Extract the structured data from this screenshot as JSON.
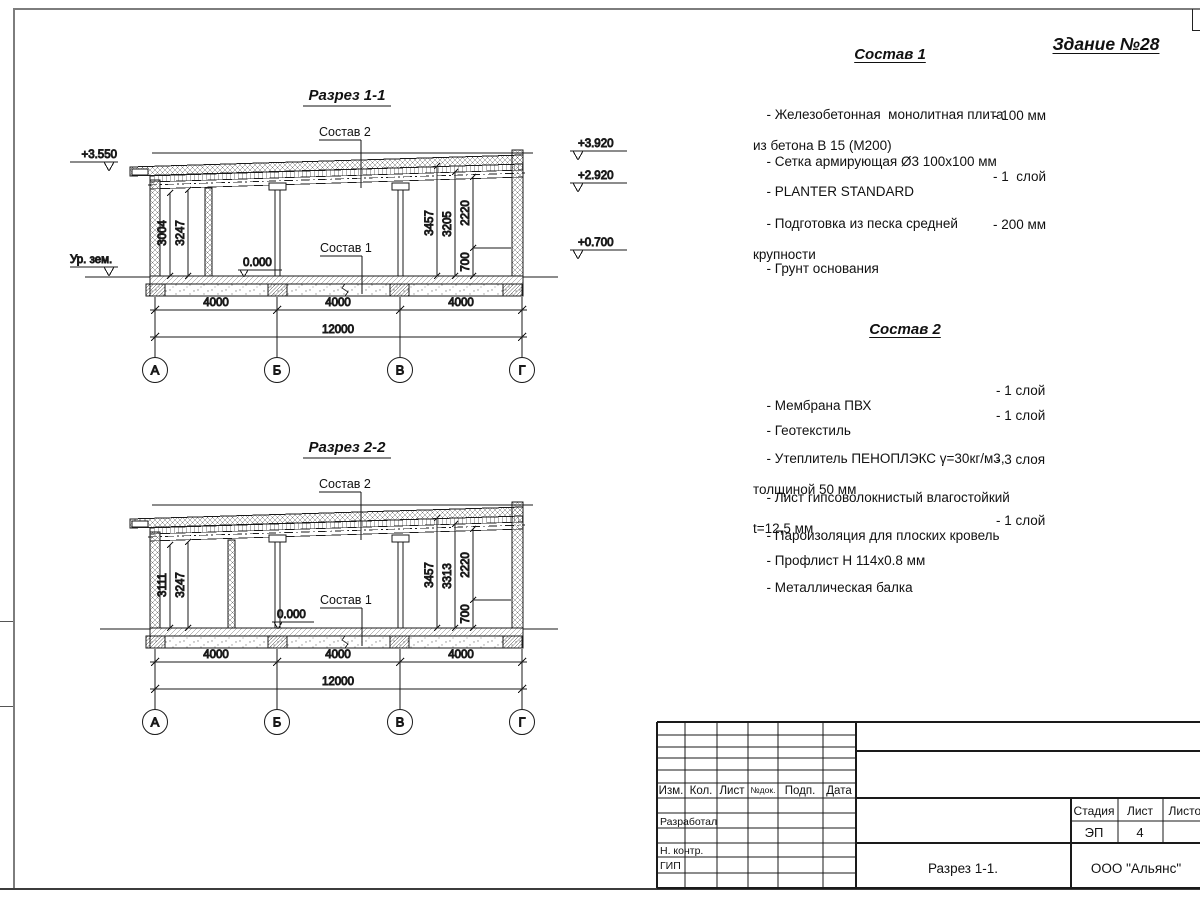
{
  "page": {
    "building_title": "Здание №28"
  },
  "sections": [
    {
      "title": "Разрез 1-1",
      "sostav2_label": "Состав 2",
      "sostav1_label": "Состав 1",
      "zero_mark": "0.000",
      "elev_left": "+3.550",
      "ground_label": "Ур. зем.",
      "elev_right": [
        "+3.920",
        "+2.920",
        "+0.700"
      ],
      "dims_left": [
        "3004",
        "3247"
      ],
      "dims_right": [
        "3457",
        "3205",
        "2220",
        "700"
      ],
      "span_dims": [
        "4000",
        "4000",
        "4000"
      ],
      "total_dim": "12000",
      "axes": [
        "А",
        "Б",
        "В",
        "Г"
      ]
    },
    {
      "title": "Разрез 2-2",
      "sostav2_label": "Состав 2",
      "sostav1_label": "Состав 1",
      "zero_mark": "0.000",
      "dims_left": [
        "3111",
        "3247"
      ],
      "dims_right": [
        "3457",
        "3313",
        "2220",
        "700"
      ],
      "span_dims": [
        "4000",
        "4000",
        "4000"
      ],
      "total_dim": "12000",
      "axes": [
        "А",
        "Б",
        "В",
        "Г"
      ]
    }
  ],
  "sostav1": {
    "heading": "Состав 1",
    "items": [
      {
        "text1": "- Железобетонная  монолитная плита",
        "text2": "из бетона В 15 (М200)",
        "value": "- 100 мм"
      },
      {
        "text1": "- Сетка армирующая Ø3 100х100 мм"
      },
      {
        "text1": "- PLANTER STANDARD",
        "value": "- 1  слой"
      },
      {
        "text1": "- Подготовка из песка средней",
        "text2": "крупности",
        "value": "- 200 мм"
      },
      {
        "text1": "- Грунт основания"
      }
    ]
  },
  "sostav2": {
    "heading": "Состав 2",
    "items": [
      {
        "text1": "- Мембрана ПВХ",
        "value": "- 1 слой"
      },
      {
        "text1": "- Геотекстиль",
        "value": "- 1 слой"
      },
      {
        "text1": "- Утеплитель ПЕНОПЛЭКС γ=30кг/м3,",
        "text2": "толщиной 50 мм",
        "value": "- 3 слоя"
      },
      {
        "text1": "- Лист гипсоволокнистый влагостойкий",
        "text2": "t=12,5 мм"
      },
      {
        "text1": "- Пароизоляция для плоских кровель",
        "value": "- 1 слой"
      },
      {
        "text1": "- Профлист Н 114х0.8 мм"
      },
      {
        "text1": "- Металлическая балка"
      }
    ]
  },
  "title_block": {
    "header_cols": [
      "Изм.",
      "Кол.",
      "Лист",
      "№док.",
      "Подп.",
      "Дата"
    ],
    "row_labels": [
      "Разработал",
      "Н. контр.",
      "ГИП"
    ],
    "stage_label": "Стадия",
    "sheet_label": "Лист",
    "sheets_label": "Листов",
    "stage_value": "ЭП",
    "sheet_value": "4",
    "drawing_name": "Разрез 1-1.",
    "company": "ООО \"Альянс\""
  }
}
